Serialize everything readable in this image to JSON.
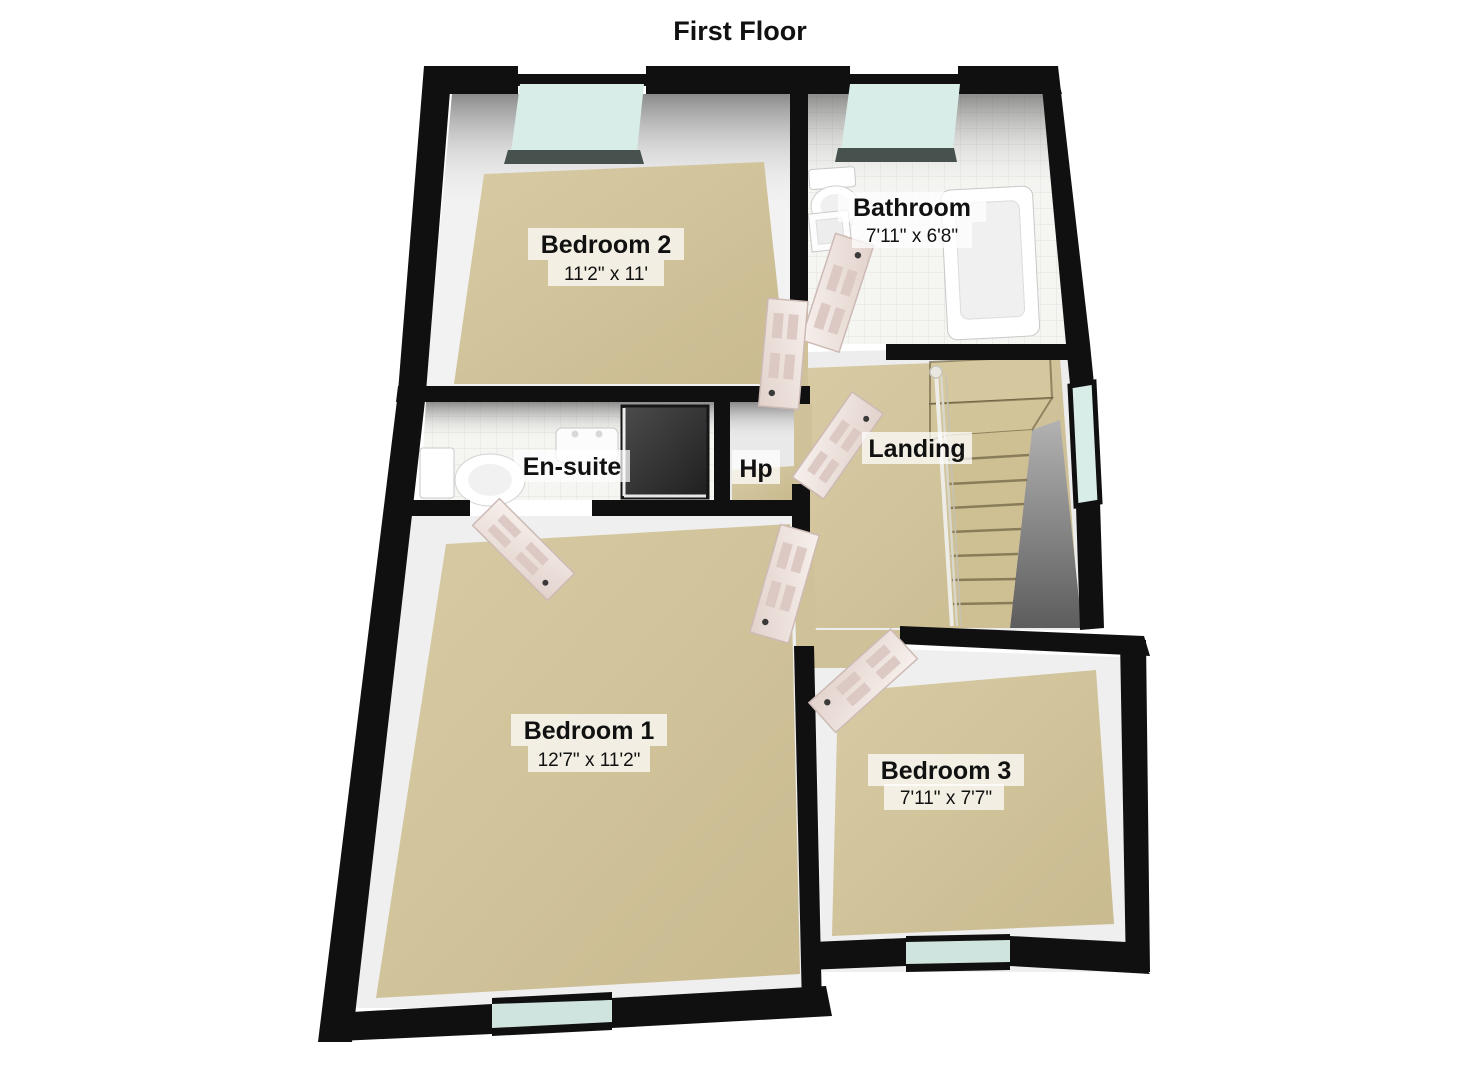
{
  "title": "First Floor",
  "rooms": {
    "bedroom2": {
      "name": "Bedroom 2",
      "dims": "11'2\" x 11'"
    },
    "bathroom": {
      "name": "Bathroom",
      "dims": "7'11\" x 6'8\""
    },
    "ensuite": {
      "name": "En-suite"
    },
    "hp": {
      "name": "Hp"
    },
    "landing": {
      "name": "Landing"
    },
    "bedroom1": {
      "name": "Bedroom 1",
      "dims": "12'7\" x 11'2\""
    },
    "bedroom3": {
      "name": "Bedroom 3",
      "dims": "7'11\" x 7'7\""
    }
  },
  "colors": {
    "wall": "#101010",
    "carpet": "#d2c49b",
    "tile": "#f4f4f1",
    "window_glass": "#d8ece8",
    "window_sill": "#47514e",
    "door_panel": "#eee2dd",
    "stairwell_shadow": "#6f6f6f",
    "label_background": "rgba(255,255,255,0.72)",
    "text": "#111111"
  }
}
